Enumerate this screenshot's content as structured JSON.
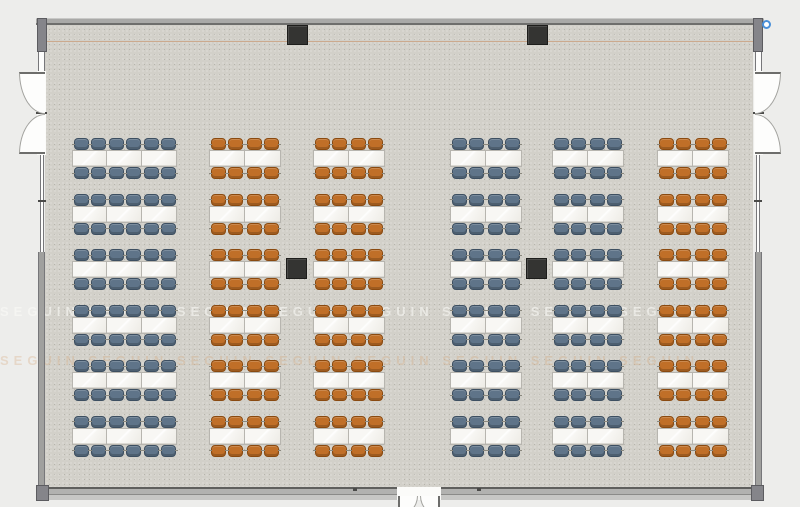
{
  "title": "banquet-room-floor-plan",
  "watermark": {
    "text": "SEGUIN",
    "display": "SEGUIN      SEGUIN      SEGUIN      SEGUIN      SEGUIN      SEGUIN      SEGUIN      SEGUIN"
  },
  "colors": {
    "exterior": "#ededeb",
    "floor": "#d2d0c9",
    "wall": "#a9a9a7",
    "wall_edge": "#6e6e6c",
    "pillar": "#343432",
    "table": "#f6f5f1",
    "chair_blue": "#5f7489",
    "chair_blue_border": "#3d4f61",
    "chair_orange": "#c06f28",
    "chair_orange_border": "#8a4a10",
    "guide_line": "#c57d48",
    "marker_blue": "#4a90d9",
    "door_swing": "#fdfdfc"
  },
  "room": {
    "inner_x": 45,
    "inner_y": 25,
    "inner_width": 708,
    "inner_height": 462
  },
  "layout": {
    "rows": 6,
    "row_start_y": 137,
    "row_pitch": 55.5,
    "seats_per_table": 4,
    "tables_total": 78,
    "seats_total": 312,
    "columns": [
      {
        "id": "column-1",
        "x": 72,
        "tables": 3,
        "table_w": 35,
        "chair_color": "blue"
      },
      {
        "id": "column-2",
        "x": 209,
        "tables": 2,
        "table_w": 36,
        "chair_color": "orange"
      },
      {
        "id": "column-3",
        "x": 313,
        "tables": 2,
        "table_w": 36,
        "chair_color": "orange"
      },
      {
        "id": "column-4",
        "x": 450,
        "tables": 2,
        "table_w": 36,
        "chair_color": "blue"
      },
      {
        "id": "column-5",
        "x": 552,
        "tables": 2,
        "table_w": 36,
        "chair_color": "blue"
      },
      {
        "id": "column-6",
        "x": 657,
        "tables": 2,
        "table_w": 36,
        "chair_color": "orange"
      }
    ]
  },
  "pillars": {
    "size": 21,
    "wall_mounted": [
      {
        "x": 287,
        "y": 25
      },
      {
        "x": 527,
        "y": 25
      }
    ],
    "freestanding": [
      {
        "x": 286,
        "y": 258
      },
      {
        "x": 526,
        "y": 258
      }
    ]
  },
  "doors": {
    "left_wall": {
      "opening_top": 72,
      "opening_bottom": 154,
      "leaves": 2,
      "swing": "outward-left"
    },
    "right_wall": {
      "opening_top": 72,
      "opening_bottom": 154,
      "leaves": 2,
      "swing": "outward-right"
    },
    "bottom_wall": {
      "opening_left": 398,
      "opening_right": 440,
      "leaves": 2,
      "swing": "outward-down"
    }
  }
}
